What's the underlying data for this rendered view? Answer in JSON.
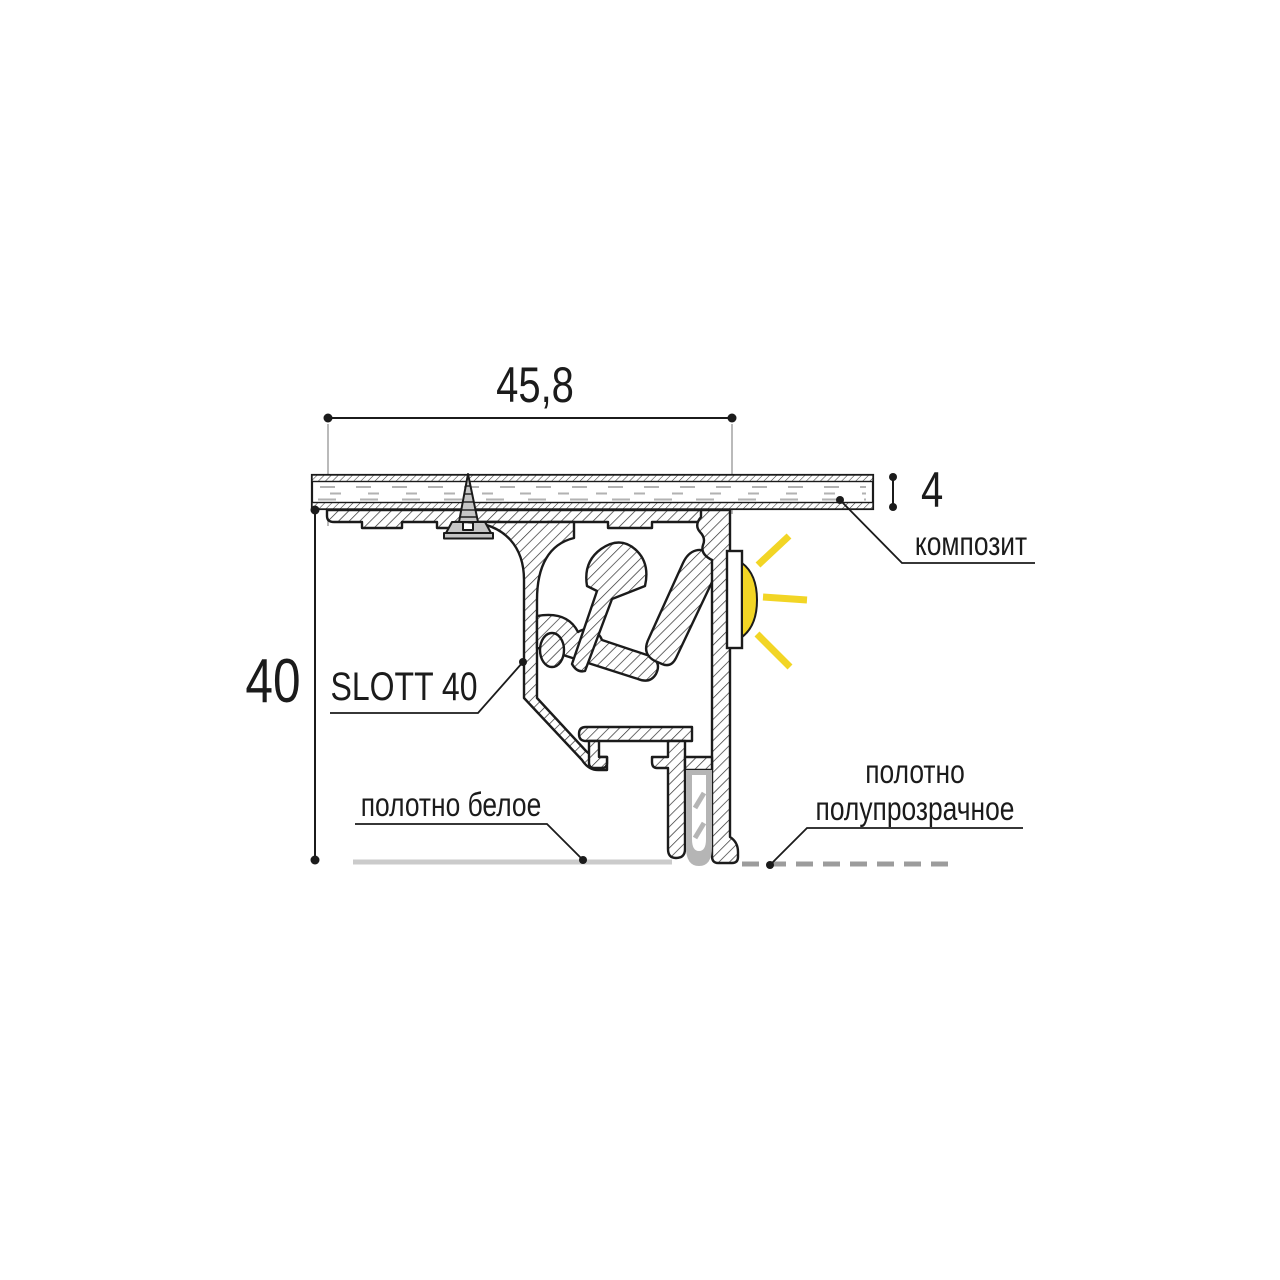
{
  "diagram": {
    "dimensions": {
      "width": "45,8",
      "height": "40",
      "panel_thickness": "4"
    },
    "labels": {
      "composite": "композит",
      "profile_name": "SLOTT 40",
      "white_fabric": "полотно белое",
      "translucent_fabric_line1": "полотно",
      "translucent_fabric_line2": "полупрозрачное"
    },
    "colors": {
      "outline": "#1b1b1b",
      "led_yellow": "#f2d525",
      "screw_gray": "#c6c6c6",
      "gasket_gray": "#b5b5b5",
      "white_fabric_line": "#cbcbcb",
      "translucent_fabric_dash": "#9c9c9c",
      "extension_line_gray": "#9c9c9c",
      "panel_core_dash_gray": "#b2b2b2",
      "background": "#ffffff"
    },
    "icons": {
      "led": "led-light-icon",
      "screw": "screw-icon"
    }
  }
}
